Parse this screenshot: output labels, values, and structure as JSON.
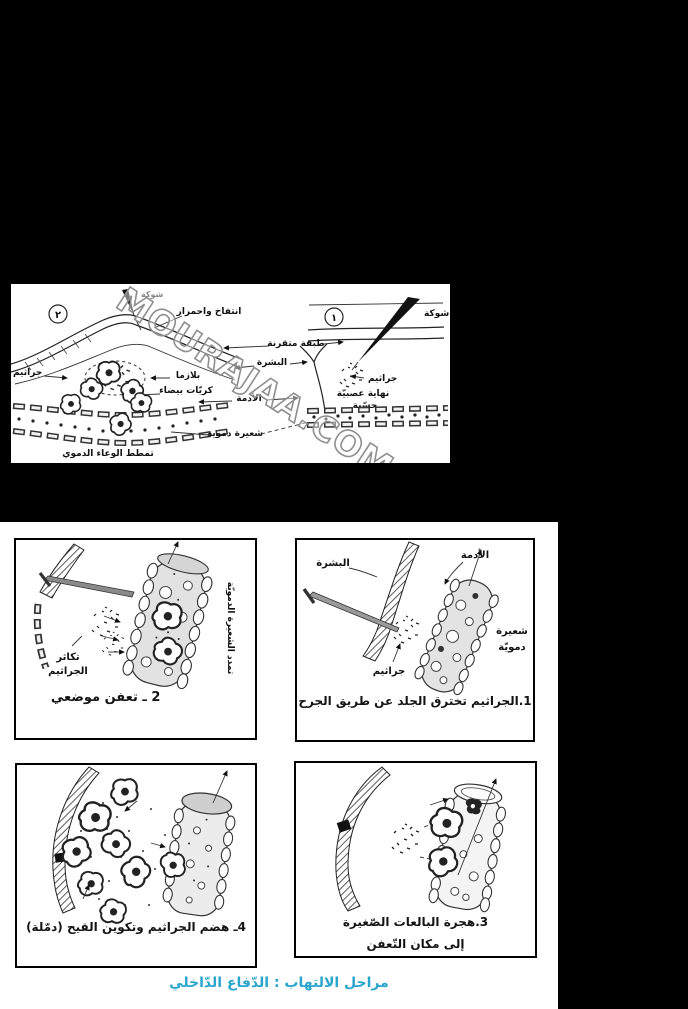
{
  "colors": {
    "background": "#000000",
    "paper": "#ffffff",
    "ink": "#1a1a1a",
    "watermark_stroke": "#8f8f8f",
    "footer_text": "#2aa6cc"
  },
  "watermark": {
    "text": "MOURAJAA.COM"
  },
  "top_diagram": {
    "right_stage": {
      "number": "١",
      "thorn": "شوكة",
      "keratin_layer": "طبقة متقرنة",
      "epidermis": "البشرة",
      "dermis": "الأدمة",
      "germs": "جراثيم",
      "nerve_line1": "نهاية عصبيّة",
      "nerve_line2": "حسّية",
      "capillary": "شعيرة دموية"
    },
    "left_stage": {
      "number": "٢",
      "thorn": "شوكة",
      "swelling": "انتفاخ واحمرار",
      "germs": "جراثيم",
      "plasma": "بلازما",
      "white_cells": "كريّات بيضاء",
      "vessel_dilation": "تمطط الوعاء الدموي"
    }
  },
  "stage1": {
    "caption": "1.الجراثيم تخترق الجلد عن طريق الجرح",
    "dermis": "الأدمة",
    "epidermis": "البشرة",
    "capillary_line1": "شعيرة",
    "capillary_line2": "دمويّة",
    "germs": "جراثيم"
  },
  "stage2": {
    "caption": "2 ـ تعفن موضعي",
    "growth_line1": "تكاثر",
    "growth_line2": "الجراثيم",
    "capillary_dilation": "تمدد الشعيرة الدمويّة"
  },
  "stage3": {
    "caption_line1": "3.هجرة البالعات الصّغيرة",
    "caption_line2": "إلى مكان التّعفن"
  },
  "stage4": {
    "caption": "4ـ هضم الجراثيم وتكوين القيح (دمّلة)"
  },
  "footer": {
    "caption": "مراحل الالتهاب : الدّفاع الدّاخلي"
  }
}
